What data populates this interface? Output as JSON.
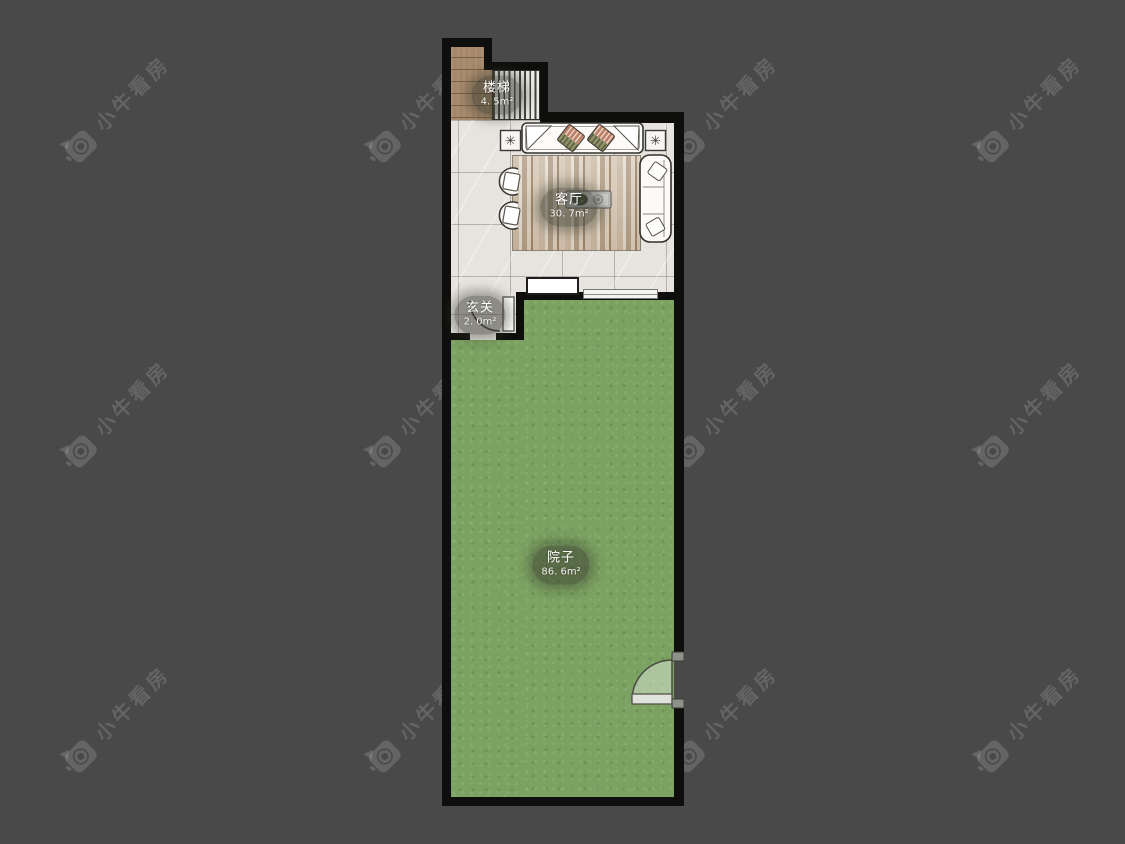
{
  "watermark": {
    "text": "小牛看房"
  },
  "icons": {
    "flower": "✳",
    "camera_logo": "camera-logo-icon"
  },
  "rooms": {
    "stairs": {
      "name": "楼梯",
      "area": "4. 5m²"
    },
    "living": {
      "name": "客厅",
      "area": "30. 7m²"
    },
    "hall": {
      "name": "玄关",
      "area": "2. 0m²"
    },
    "yard": {
      "name": "院子",
      "area": "86. 6m²"
    }
  },
  "colors": {
    "background": "#494949",
    "wall": "#0e0e0c",
    "yard_green": "#7ba261",
    "tile": "#e7e4df",
    "wood": "#a5886a",
    "watermark": "rgba(255,255,255,0.15)"
  }
}
